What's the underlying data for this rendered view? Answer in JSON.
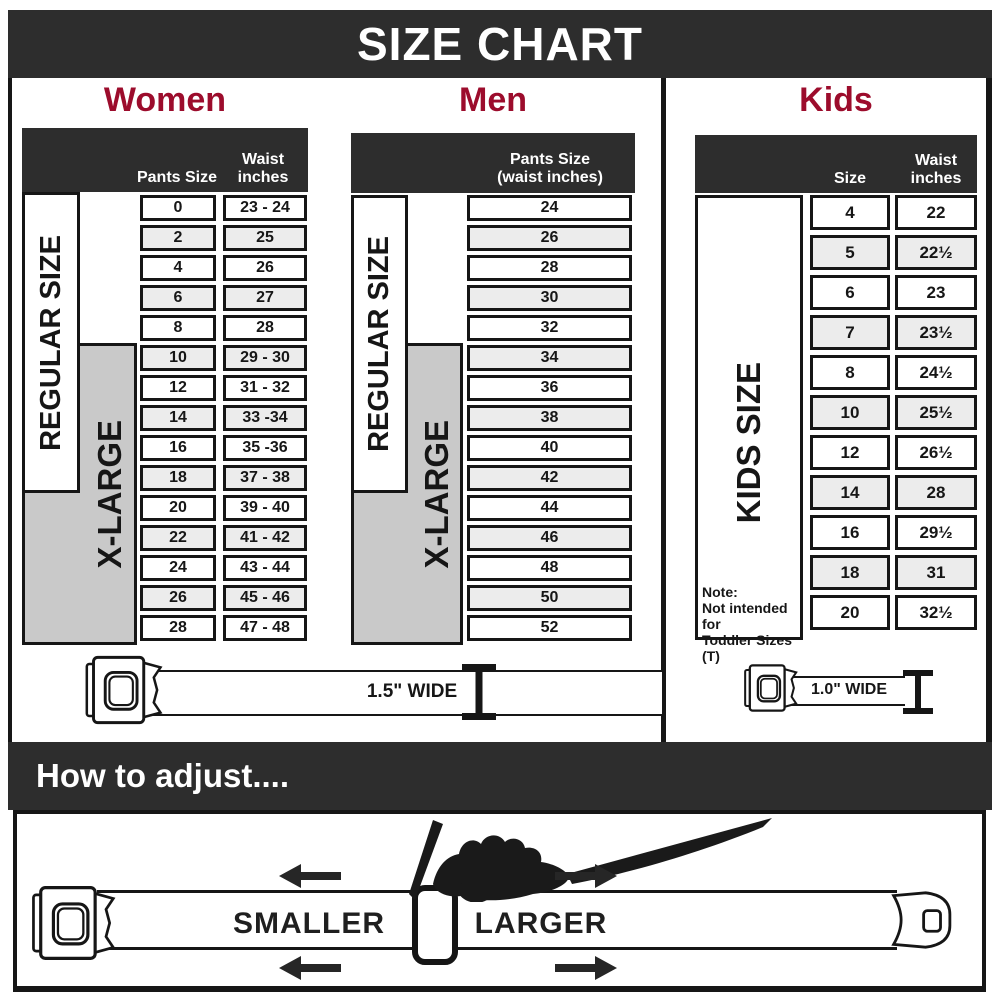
{
  "title": "SIZE CHART",
  "colors": {
    "bar_dark": "#2d2d2d",
    "accent_red": "#9c0c2c",
    "xlarge_gray": "#c9c9c9",
    "alt_row": "#ececec"
  },
  "women": {
    "heading": "Women",
    "col1_header": "Pants Size",
    "col2_header_line1": "Waist",
    "col2_header_line2": "inches",
    "regular_label": "REGULAR SIZE",
    "xlarge_label": "X-LARGE",
    "rows": [
      {
        "pants": "0",
        "waist": "23 - 24"
      },
      {
        "pants": "2",
        "waist": "25"
      },
      {
        "pants": "4",
        "waist": "26"
      },
      {
        "pants": "6",
        "waist": "27"
      },
      {
        "pants": "8",
        "waist": "28"
      },
      {
        "pants": "10",
        "waist": "29 - 30"
      },
      {
        "pants": "12",
        "waist": "31 - 32"
      },
      {
        "pants": "14",
        "waist": "33 -34"
      },
      {
        "pants": "16",
        "waist": "35 -36"
      },
      {
        "pants": "18",
        "waist": "37 - 38"
      },
      {
        "pants": "20",
        "waist": "39 - 40"
      },
      {
        "pants": "22",
        "waist": "41 - 42"
      },
      {
        "pants": "24",
        "waist": "43 - 44"
      },
      {
        "pants": "26",
        "waist": "45 - 46"
      },
      {
        "pants": "28",
        "waist": "47 - 48"
      }
    ]
  },
  "men": {
    "heading": "Men",
    "header_line1": "Pants Size",
    "header_line2": "(waist inches)",
    "regular_label": "REGULAR SIZE",
    "xlarge_label": "X-LARGE",
    "rows": [
      {
        "pants": "24"
      },
      {
        "pants": "26"
      },
      {
        "pants": "28"
      },
      {
        "pants": "30"
      },
      {
        "pants": "32"
      },
      {
        "pants": "34"
      },
      {
        "pants": "36"
      },
      {
        "pants": "38"
      },
      {
        "pants": "40"
      },
      {
        "pants": "42"
      },
      {
        "pants": "44"
      },
      {
        "pants": "46"
      },
      {
        "pants": "48"
      },
      {
        "pants": "50"
      },
      {
        "pants": "52"
      }
    ]
  },
  "kids": {
    "heading": "Kids",
    "col1_header": "Size",
    "col2_header_line1": "Waist",
    "col2_header_line2": "inches",
    "side_label": "KIDS SIZE",
    "note_line1": "Note:",
    "note_line2": "Not intended for",
    "note_line3": "Toddler Sizes (T)",
    "rows": [
      {
        "size": "4",
        "waist": "22"
      },
      {
        "size": "5",
        "waist": "22½"
      },
      {
        "size": "6",
        "waist": "23"
      },
      {
        "size": "7",
        "waist": "23½"
      },
      {
        "size": "8",
        "waist": "24½"
      },
      {
        "size": "10",
        "waist": "25½"
      },
      {
        "size": "12",
        "waist": "26½"
      },
      {
        "size": "14",
        "waist": "28"
      },
      {
        "size": "16",
        "waist": "29½"
      },
      {
        "size": "18",
        "waist": "31"
      },
      {
        "size": "20",
        "waist": "32½"
      }
    ]
  },
  "belts": {
    "adult_width_label": "1.5\" WIDE",
    "kids_width_label": "1.0\" WIDE"
  },
  "adjust": {
    "heading": "How to adjust....",
    "smaller_label": "SMALLER",
    "larger_label": "LARGER"
  },
  "chart_data": [
    {
      "type": "table",
      "title": "Women",
      "columns": [
        "Pants Size",
        "Waist inches"
      ],
      "rows": [
        [
          "0",
          "23 - 24"
        ],
        [
          "2",
          "25"
        ],
        [
          "4",
          "26"
        ],
        [
          "6",
          "27"
        ],
        [
          "8",
          "28"
        ],
        [
          "10",
          "29 - 30"
        ],
        [
          "12",
          "31 - 32"
        ],
        [
          "14",
          "33 -34"
        ],
        [
          "16",
          "35 -36"
        ],
        [
          "18",
          "37 - 38"
        ],
        [
          "20",
          "39 - 40"
        ],
        [
          "22",
          "41 - 42"
        ],
        [
          "24",
          "43 - 44"
        ],
        [
          "26",
          "45 - 46"
        ],
        [
          "28",
          "47 - 48"
        ]
      ],
      "regular_size_range": "pants 0 - 18",
      "x_large_range": "pants 10 - 28",
      "belt_width": "1.5\" WIDE"
    },
    {
      "type": "table",
      "title": "Men",
      "columns": [
        "Pants Size (waist inches)"
      ],
      "rows": [
        [
          "24"
        ],
        [
          "26"
        ],
        [
          "28"
        ],
        [
          "30"
        ],
        [
          "32"
        ],
        [
          "34"
        ],
        [
          "36"
        ],
        [
          "38"
        ],
        [
          "40"
        ],
        [
          "42"
        ],
        [
          "44"
        ],
        [
          "46"
        ],
        [
          "48"
        ],
        [
          "50"
        ],
        [
          "52"
        ]
      ],
      "regular_size_range": "24 - 42",
      "x_large_range": "34 - 52",
      "belt_width": "1.5\" WIDE"
    },
    {
      "type": "table",
      "title": "Kids",
      "columns": [
        "Size",
        "Waist inches"
      ],
      "rows": [
        [
          "4",
          "22"
        ],
        [
          "5",
          "22½"
        ],
        [
          "6",
          "23"
        ],
        [
          "7",
          "23½"
        ],
        [
          "8",
          "24½"
        ],
        [
          "10",
          "25½"
        ],
        [
          "12",
          "26½"
        ],
        [
          "14",
          "28"
        ],
        [
          "16",
          "29½"
        ],
        [
          "18",
          "31"
        ],
        [
          "20",
          "32½"
        ]
      ],
      "note": "Not intended for Toddler Sizes (T)",
      "belt_width": "1.0\" WIDE"
    }
  ]
}
